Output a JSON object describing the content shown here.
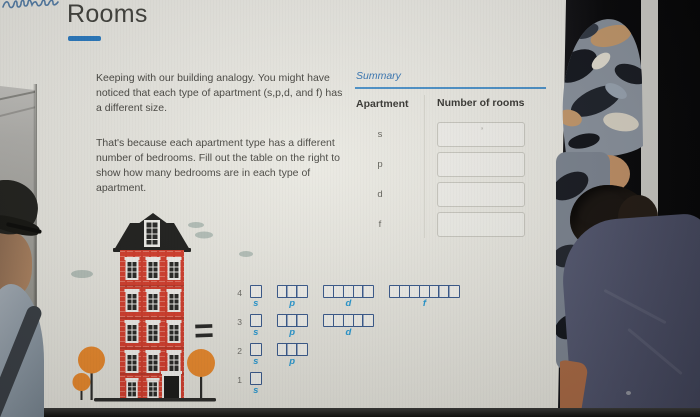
{
  "header": {
    "title": "Rooms"
  },
  "intro": {
    "p1": "Keeping with our building analogy. You might have noticed that each type of apartment (s,p,d, and f) has a different size.",
    "p2": "That's because each apartment type has a different number of bedrooms. Fill out the table on the right to show how many bedrooms are in each type of apartment."
  },
  "summary": {
    "title": "Summary",
    "col_apartment": "Apartment",
    "col_rooms": "Number of rooms",
    "rows": [
      {
        "apartment": "s",
        "value": ""
      },
      {
        "apartment": "p",
        "value": ""
      },
      {
        "apartment": "d",
        "value": ""
      },
      {
        "apartment": "f",
        "value": ""
      }
    ],
    "first_box_mark": "’"
  },
  "comparison": {
    "equals": "="
  },
  "orbital_diagram": {
    "rows": [
      {
        "level": "4",
        "groups": [
          {
            "label": "s",
            "boxes": 1
          },
          {
            "label": "p",
            "boxes": 3
          },
          {
            "label": "d",
            "boxes": 5
          },
          {
            "label": "f",
            "boxes": 7
          }
        ]
      },
      {
        "level": "3",
        "groups": [
          {
            "label": "s",
            "boxes": 1
          },
          {
            "label": "p",
            "boxes": 3
          },
          {
            "label": "d",
            "boxes": 5
          }
        ]
      },
      {
        "level": "2",
        "groups": [
          {
            "label": "s",
            "boxes": 1
          },
          {
            "label": "p",
            "boxes": 3
          }
        ]
      },
      {
        "level": "1",
        "groups": [
          {
            "label": "s",
            "boxes": 1
          }
        ]
      }
    ]
  },
  "colors": {
    "accent_blue": "#2c7dc4",
    "summary_blue": "#3b79b6",
    "orbital_box_border": "#3b5b8e",
    "orbital_label_cyan": "#2a9ad2",
    "building_red": "#d7402f",
    "tree_orange": "#ea8a2e"
  }
}
